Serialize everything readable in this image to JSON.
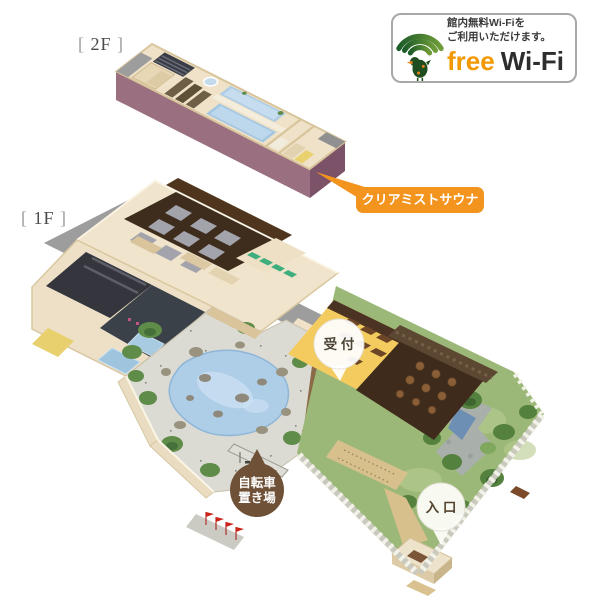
{
  "wifi_badge": {
    "line1": "館内無料Wi-Fiを",
    "line2": "ご利用いただけます。",
    "free": "free",
    "wifi": "Wi-Fi"
  },
  "floors": {
    "f2": {
      "prefix": "[ ",
      "label": "2F",
      "suffix": " ]"
    },
    "f1": {
      "prefix": "[ ",
      "label": "1F",
      "suffix": " ]"
    }
  },
  "callouts": {
    "sauna": "クリアミストサウナ",
    "reception": "受 付",
    "bicycle_line1": "自転車",
    "bicycle_line2": "置き場",
    "entrance": "入 口"
  },
  "palette": {
    "callout_orange": "#f3941f",
    "marker_brown": "#6f5138",
    "wall_mauve": "#9a7081",
    "wall_mauve_dark": "#7c5268",
    "floor_cream": "#f0e4cc",
    "pool_blue": "#aecde7",
    "courtyard_stone": "#dbdbd3",
    "garden_green": "#9cb878",
    "roof_gray": "#9d9d9d",
    "relax_floor_brown": "#3e2c1c",
    "dining_yellow": "#f3cb5e",
    "deck_brown": "#3f2b1c",
    "free_orange": "#f39800",
    "wifi_green_dark": "#1c5c28",
    "wifi_green_light": "#6f9c38"
  }
}
